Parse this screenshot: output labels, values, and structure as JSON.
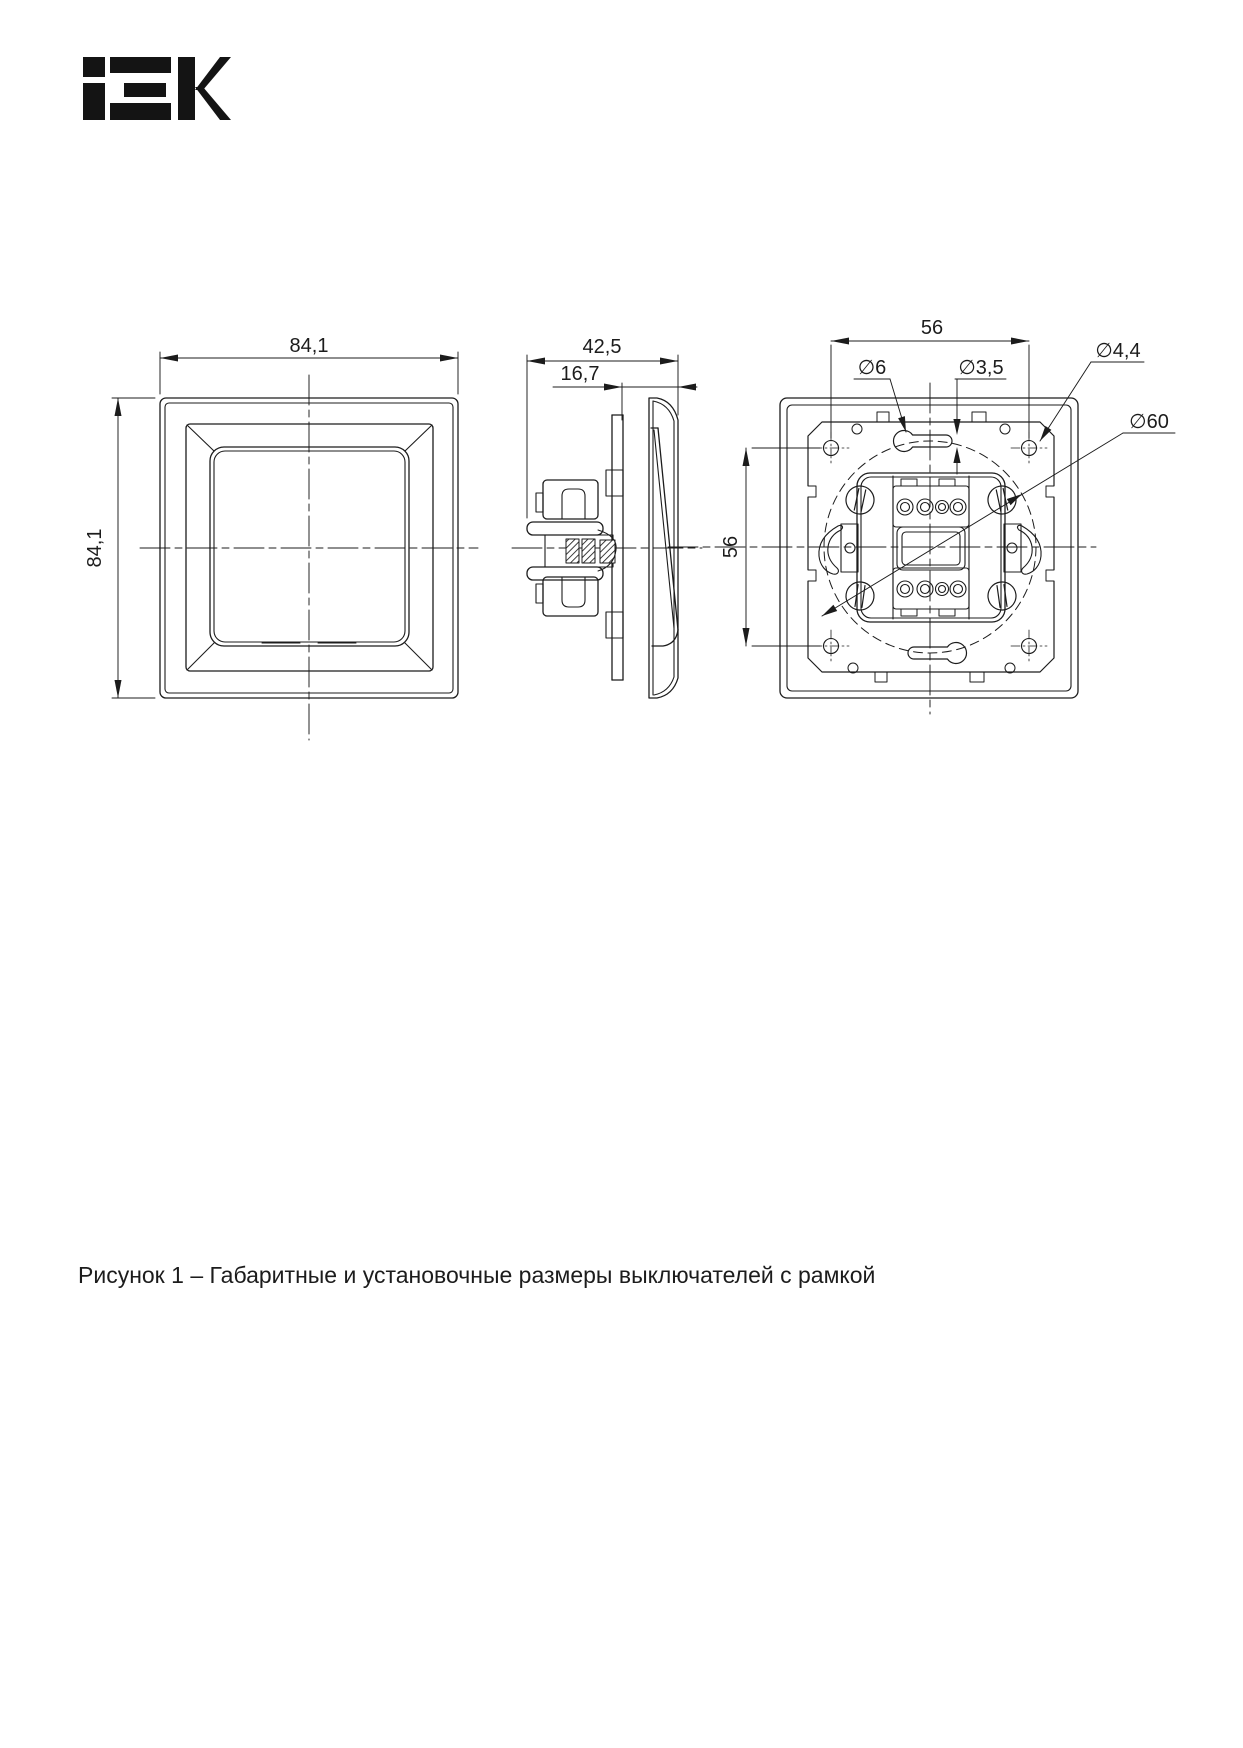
{
  "page": {
    "background": "#ffffff",
    "ink": "#1c1c1c"
  },
  "brand": {
    "name": "iEK"
  },
  "views": {
    "front": {
      "label_width": "84,1",
      "label_height": "84,1"
    },
    "side": {
      "label_depth": "42,5",
      "label_protrusion": "16,7"
    },
    "back": {
      "label_spacing_horizontal": "56",
      "label_spacing_vertical": "56",
      "label_keyhole_diameter": "∅6",
      "label_slot_width": "∅3,5",
      "label_screw_hole_diameter": "∅4,4",
      "label_mounting_circle_diameter": "∅60"
    }
  },
  "caption": "Рисунок 1 – Габаритные и установочные размеры выключателей с рамкой"
}
